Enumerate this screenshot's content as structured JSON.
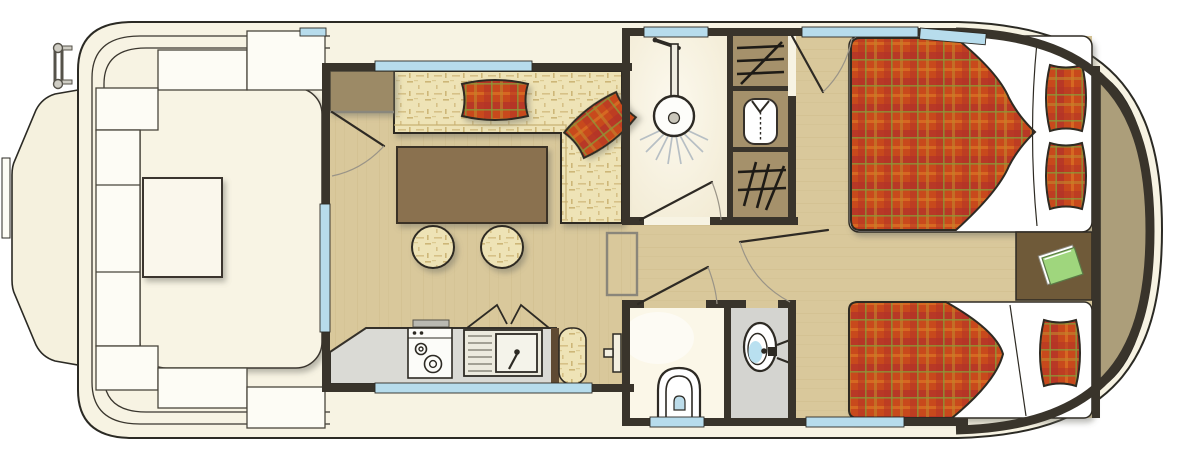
{
  "title": "houseboat-floor-plan",
  "colors": {
    "page_bg": "#ffffff",
    "hull": "#f7f3e3",
    "hull_outline": "#2b2a24",
    "bench": "#fdfcf5",
    "deck_center": "#f8f4e4",
    "deck_table": "#faf7ec",
    "wall": "#39342b",
    "window": "#b7dcec",
    "floor_base": "#d9c89b",
    "floor_grain": "#cfbd8c",
    "fabric_base": "#eee3b6",
    "plaid_base": "#c84a1e",
    "plaid_dark": "#b23226",
    "plaid_orange": "#d96c22",
    "plaid_olive": "#8a9638",
    "table": "#8a7150",
    "cabinet": "#9c8a66",
    "closet": "#a5916b",
    "counter": "#dadad5",
    "counter_seat_trim": "#5f4a33",
    "shower_floor": "#f3ecd6",
    "wc_floor": "#fbf7e8",
    "washroom_floor": "#d4d4d0",
    "fixture_white": "#fdfdfa",
    "basin_blue": "#b9e0f0",
    "nightstand": "#6f5a39",
    "stern_platform": "#ac9e7a",
    "book_green": "#9fd67d",
    "steps_outline": "#8a867a",
    "spray": "#b7bfc4"
  },
  "areas": {
    "foredeck": {
      "name": "foredeck",
      "fixtures": [
        "wraparound bench seating",
        "deck table",
        "swim ladder",
        "bow platform"
      ]
    },
    "salon": {
      "name": "salon",
      "fixtures": [
        "l-shaped sofa",
        "2 plaid cushions",
        "dining table",
        "2 stools",
        "entry door",
        "storage cabinet"
      ]
    },
    "galley": {
      "name": "galley",
      "fixtures": [
        "counter",
        "2-burner stove",
        "sink with drainer",
        "bench seat"
      ]
    },
    "shower_room": {
      "name": "shower room",
      "fixtures": [
        "shower head"
      ]
    },
    "wardrobes": {
      "name": "wardrobes",
      "fixtures": [
        "shelf locker",
        "hanging wardrobe",
        "shelf locker"
      ]
    },
    "corridor": {
      "name": "corridor",
      "fixtures": [
        "steps",
        "wall heater"
      ]
    },
    "wc": {
      "name": "wc",
      "fixtures": [
        "toilet"
      ]
    },
    "washroom": {
      "name": "washroom",
      "fixtures": [
        "washbasin with tap"
      ]
    },
    "cabin": {
      "name": "aft cabin",
      "fixtures": [
        "double bed",
        "single bed",
        "3 plaid pillows",
        "nightstand",
        "green book"
      ]
    },
    "stern": {
      "name": "stern platform",
      "fixtures": []
    }
  },
  "windows_count": 9,
  "doors_count": 5
}
